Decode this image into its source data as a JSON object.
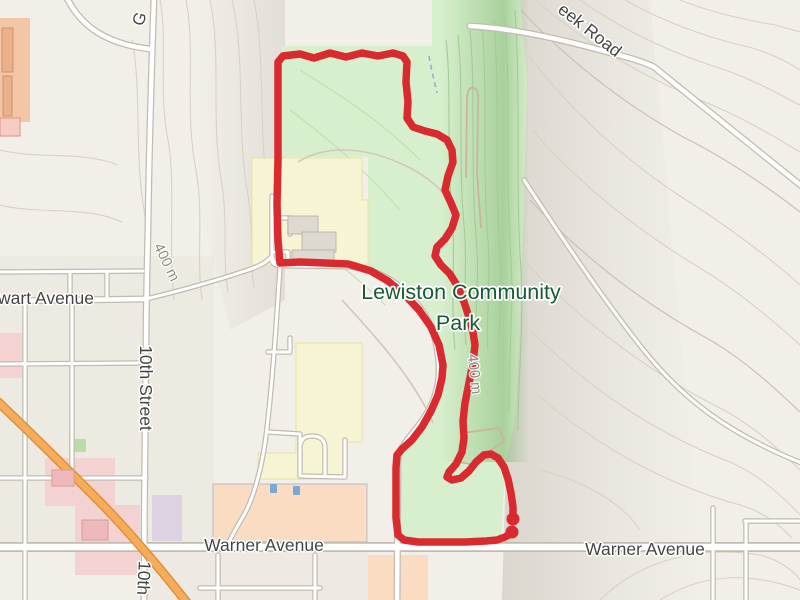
{
  "map": {
    "type": "trail-route-map",
    "labels": {
      "park": {
        "line1": "Lewiston Community",
        "line2": "Park"
      },
      "warner_west": "Warner Avenue",
      "warner_east": "Warner Avenue",
      "stewart_partial": "wart Avenue",
      "tenth_street": "10th Street",
      "tenth_partial": "10th",
      "creek_road_partial": "eek Road",
      "street_partial_g": "G",
      "contour_west": "400 m",
      "contour_park": "400 m"
    },
    "colors": {
      "background": "#f2efe9",
      "park_green": "#d8efcd",
      "ravine_green": "#a9d49c",
      "route_red": "#d92b2f",
      "road_fill": "#ffffff",
      "road_casing": "#c2bcb0",
      "highway_orange": "#f6ac58",
      "school_yellow": "#f7f4d4",
      "retail_peach": "#fadcc2",
      "hospital_pink": "#f4d2d2",
      "park_label_green": "#165c30",
      "street_label_gray": "#454545",
      "contour_label_gray": "#8f8b7d",
      "water_blue": "#8ab6d4"
    },
    "route": {
      "color": "#d92b2f",
      "stroke_width": 7.5,
      "endpoint_radius": 6.5,
      "points": [
        [
          512,
          533
        ],
        [
          505,
          537
        ],
        [
          497,
          540
        ],
        [
          486,
          541
        ],
        [
          465,
          542
        ],
        [
          440,
          542
        ],
        [
          418,
          542
        ],
        [
          404,
          540
        ],
        [
          398,
          535
        ],
        [
          396,
          518
        ],
        [
          396,
          492
        ],
        [
          396,
          468
        ],
        [
          397,
          455
        ],
        [
          402,
          449
        ],
        [
          412,
          440
        ],
        [
          422,
          427
        ],
        [
          431,
          411
        ],
        [
          438,
          395
        ],
        [
          442,
          378
        ],
        [
          443,
          365
        ],
        [
          439,
          345
        ],
        [
          431,
          327
        ],
        [
          419,
          310
        ],
        [
          404,
          294
        ],
        [
          388,
          281
        ],
        [
          371,
          271
        ],
        [
          355,
          266
        ],
        [
          348,
          264
        ],
        [
          325,
          263
        ],
        [
          300,
          262
        ],
        [
          280,
          263
        ],
        [
          278,
          240
        ],
        [
          277,
          205
        ],
        [
          278,
          160
        ],
        [
          278,
          110
        ],
        [
          278,
          62
        ],
        [
          283,
          56
        ],
        [
          300,
          54
        ],
        [
          314,
          58
        ],
        [
          330,
          53
        ],
        [
          346,
          57
        ],
        [
          362,
          53
        ],
        [
          378,
          56
        ],
        [
          393,
          53
        ],
        [
          403,
          56
        ],
        [
          407,
          62
        ],
        [
          406,
          82
        ],
        [
          408,
          102
        ],
        [
          407,
          118
        ],
        [
          413,
          127
        ],
        [
          425,
          131
        ],
        [
          437,
          134
        ],
        [
          447,
          140
        ],
        [
          452,
          150
        ],
        [
          453,
          162
        ],
        [
          448,
          176
        ],
        [
          445,
          190
        ],
        [
          451,
          203
        ],
        [
          456,
          215
        ],
        [
          452,
          228
        ],
        [
          445,
          239
        ],
        [
          437,
          247
        ],
        [
          435,
          256
        ],
        [
          441,
          265
        ],
        [
          450,
          274
        ],
        [
          458,
          287
        ],
        [
          464,
          302
        ],
        [
          469,
          317
        ],
        [
          473,
          332
        ],
        [
          475,
          345
        ],
        [
          473,
          363
        ],
        [
          469,
          383
        ],
        [
          465,
          403
        ],
        [
          463,
          421
        ],
        [
          464,
          438
        ],
        [
          462,
          452
        ],
        [
          456,
          464
        ],
        [
          449,
          472
        ],
        [
          447,
          477
        ],
        [
          452,
          480
        ],
        [
          461,
          478
        ],
        [
          469,
          471
        ],
        [
          476,
          462
        ],
        [
          484,
          455
        ],
        [
          491,
          454
        ],
        [
          498,
          458
        ],
        [
          504,
          467
        ],
        [
          508,
          479
        ],
        [
          511,
          493
        ],
        [
          513,
          507
        ],
        [
          513,
          516
        ]
      ],
      "endpoints": [
        [
          513,
          519
        ],
        [
          512,
          532
        ]
      ]
    }
  }
}
